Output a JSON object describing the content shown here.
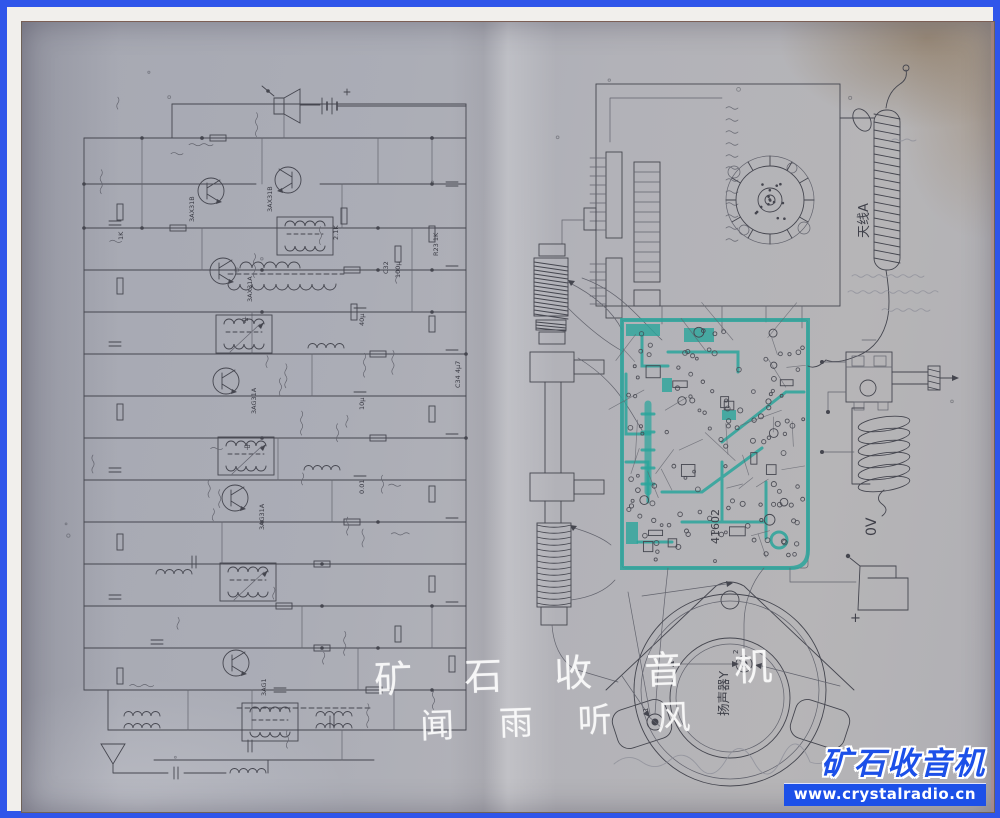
{
  "frame": {
    "border_color": "#2f55ea",
    "inner_border_color": "#f1efec"
  },
  "watermark": {
    "line1": "矿 石 收 音 机",
    "line2": "闻 雨 听 风"
  },
  "badge": {
    "title": "矿石收音机",
    "url": "www.crystalradio.cn",
    "color": "#1c50e8"
  },
  "right_page": {
    "antenna_label": "天线A",
    "speaker_label": "扬声器Y",
    "zero_volt_label": "0V",
    "pcb_number": "41602",
    "battery_plus": "+",
    "speaker_terminals": [
      "1",
      "2"
    ]
  },
  "left_page": {
    "component_labels": [
      {
        "text": "3AX31B",
        "x": 172,
        "y": 200
      },
      {
        "text": "3AX31B",
        "x": 250,
        "y": 190
      },
      {
        "text": "3AX31A",
        "x": 230,
        "y": 280
      },
      {
        "text": "3AG31A",
        "x": 234,
        "y": 392
      },
      {
        "text": "3AG31A",
        "x": 242,
        "y": 508
      },
      {
        "text": "3AG1",
        "x": 244,
        "y": 674
      },
      {
        "text": "C32",
        "x": 366,
        "y": 252,
        "fs": 6
      },
      {
        "text": "100μ",
        "x": 378,
        "y": 256,
        "fs": 6
      },
      {
        "text": "R23 1K",
        "x": 416,
        "y": 234
      },
      {
        "text": "2.1K",
        "x": 316,
        "y": 218
      },
      {
        "text": "40μ",
        "x": 342,
        "y": 304
      },
      {
        "text": "10μ",
        "x": 342,
        "y": 388
      },
      {
        "text": "0.01",
        "x": 342,
        "y": 472
      },
      {
        "text": "1K",
        "x": 101,
        "y": 218
      },
      {
        "text": "C34 4μ7",
        "x": 438,
        "y": 366
      },
      {
        "text": "中",
        "x": 220,
        "y": 300,
        "r": 0,
        "fs": 7
      },
      {
        "text": "中",
        "x": 222,
        "y": 427,
        "r": 0,
        "fs": 7
      }
    ]
  }
}
